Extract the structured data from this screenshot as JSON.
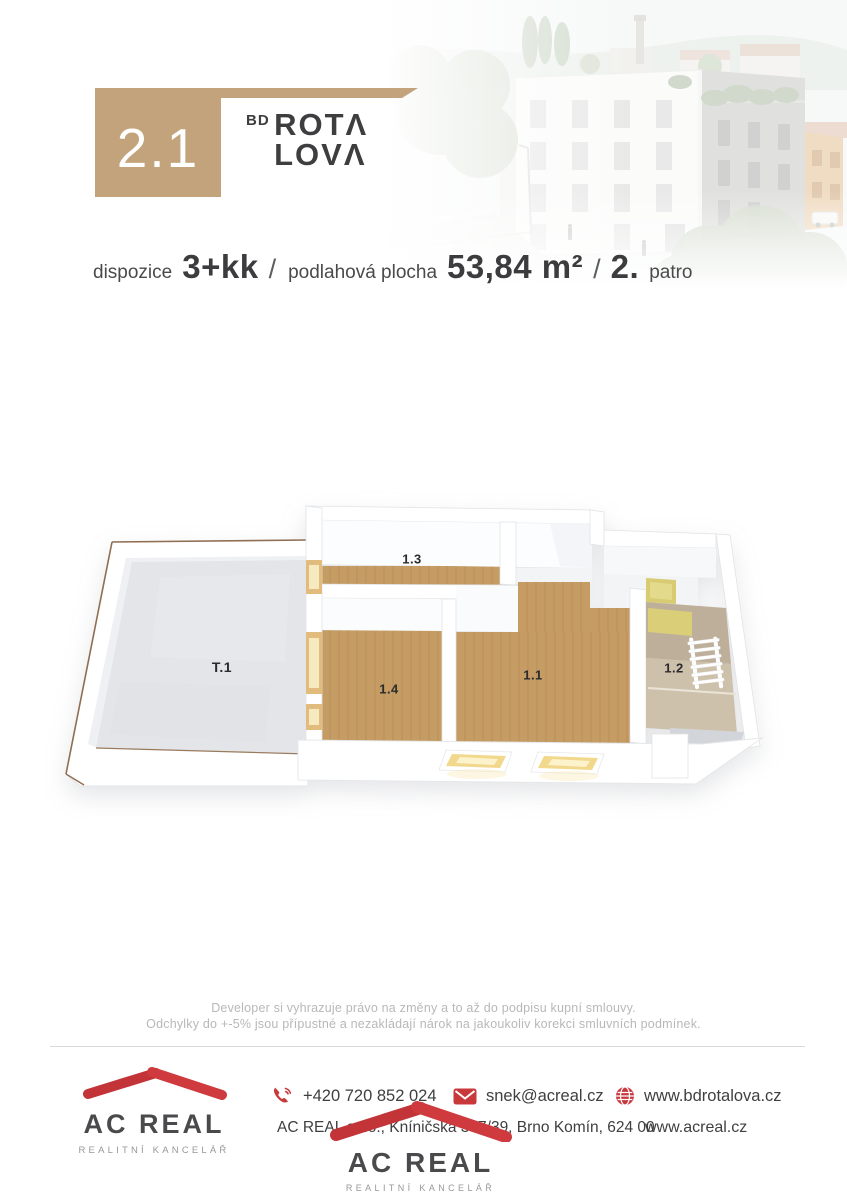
{
  "header": {
    "unit_number": "2.1",
    "brand_prefix": "BD",
    "brand_line1": "ROTΛ",
    "brand_line2": "LOVΛ",
    "subtitle": {
      "label_disposition": "dispozice",
      "value_disposition": "3+kk",
      "separator1": "/",
      "label_area": "podlahová plocha",
      "value_area": "53,84 m²",
      "separator2": "/",
      "value_floor": "2.",
      "label_floor": "patro"
    }
  },
  "floor_plan": {
    "rooms": [
      {
        "id": "T.1"
      },
      {
        "id": "1.3"
      },
      {
        "id": "1.4"
      },
      {
        "id": "1.1"
      },
      {
        "id": "1.2"
      }
    ]
  },
  "disclaimer": {
    "line1": "Developer si vyhrazuje právo na změny a to až do podpisu kupní smlouvy.",
    "line2": "Odchylky do +-5% jsou přípustné a nezakládají nárok na jakoukoliv korekci smluvních podmínek."
  },
  "footer": {
    "logo_name": "AC REAL",
    "logo_tagline": "REALITNÍ KANCELÁŘ",
    "phone": "+420 720 852 024",
    "email": "snek@acreal.cz",
    "website_project": "www.bdrotalova.cz",
    "address": "AC REAL s.r.o., Kníničská 397/39, Brno Komín, 624 00",
    "website_agency": "www.acreal.cz",
    "center_logo_name": "AC REAL",
    "center_logo_tagline": "REALITNÍ KANCELÁŘ"
  },
  "colors": {
    "accent_tan": "#c2a37b",
    "brand_red": "#c8393c",
    "text_dark": "#3f4042",
    "text_light_gray": "#b7b8ba",
    "wood_floor": "#c59c63",
    "terrace_floor": "#e3e5e8",
    "bathroom_tile": "#cec1ab",
    "accent_yellow": "#d8cb72"
  }
}
